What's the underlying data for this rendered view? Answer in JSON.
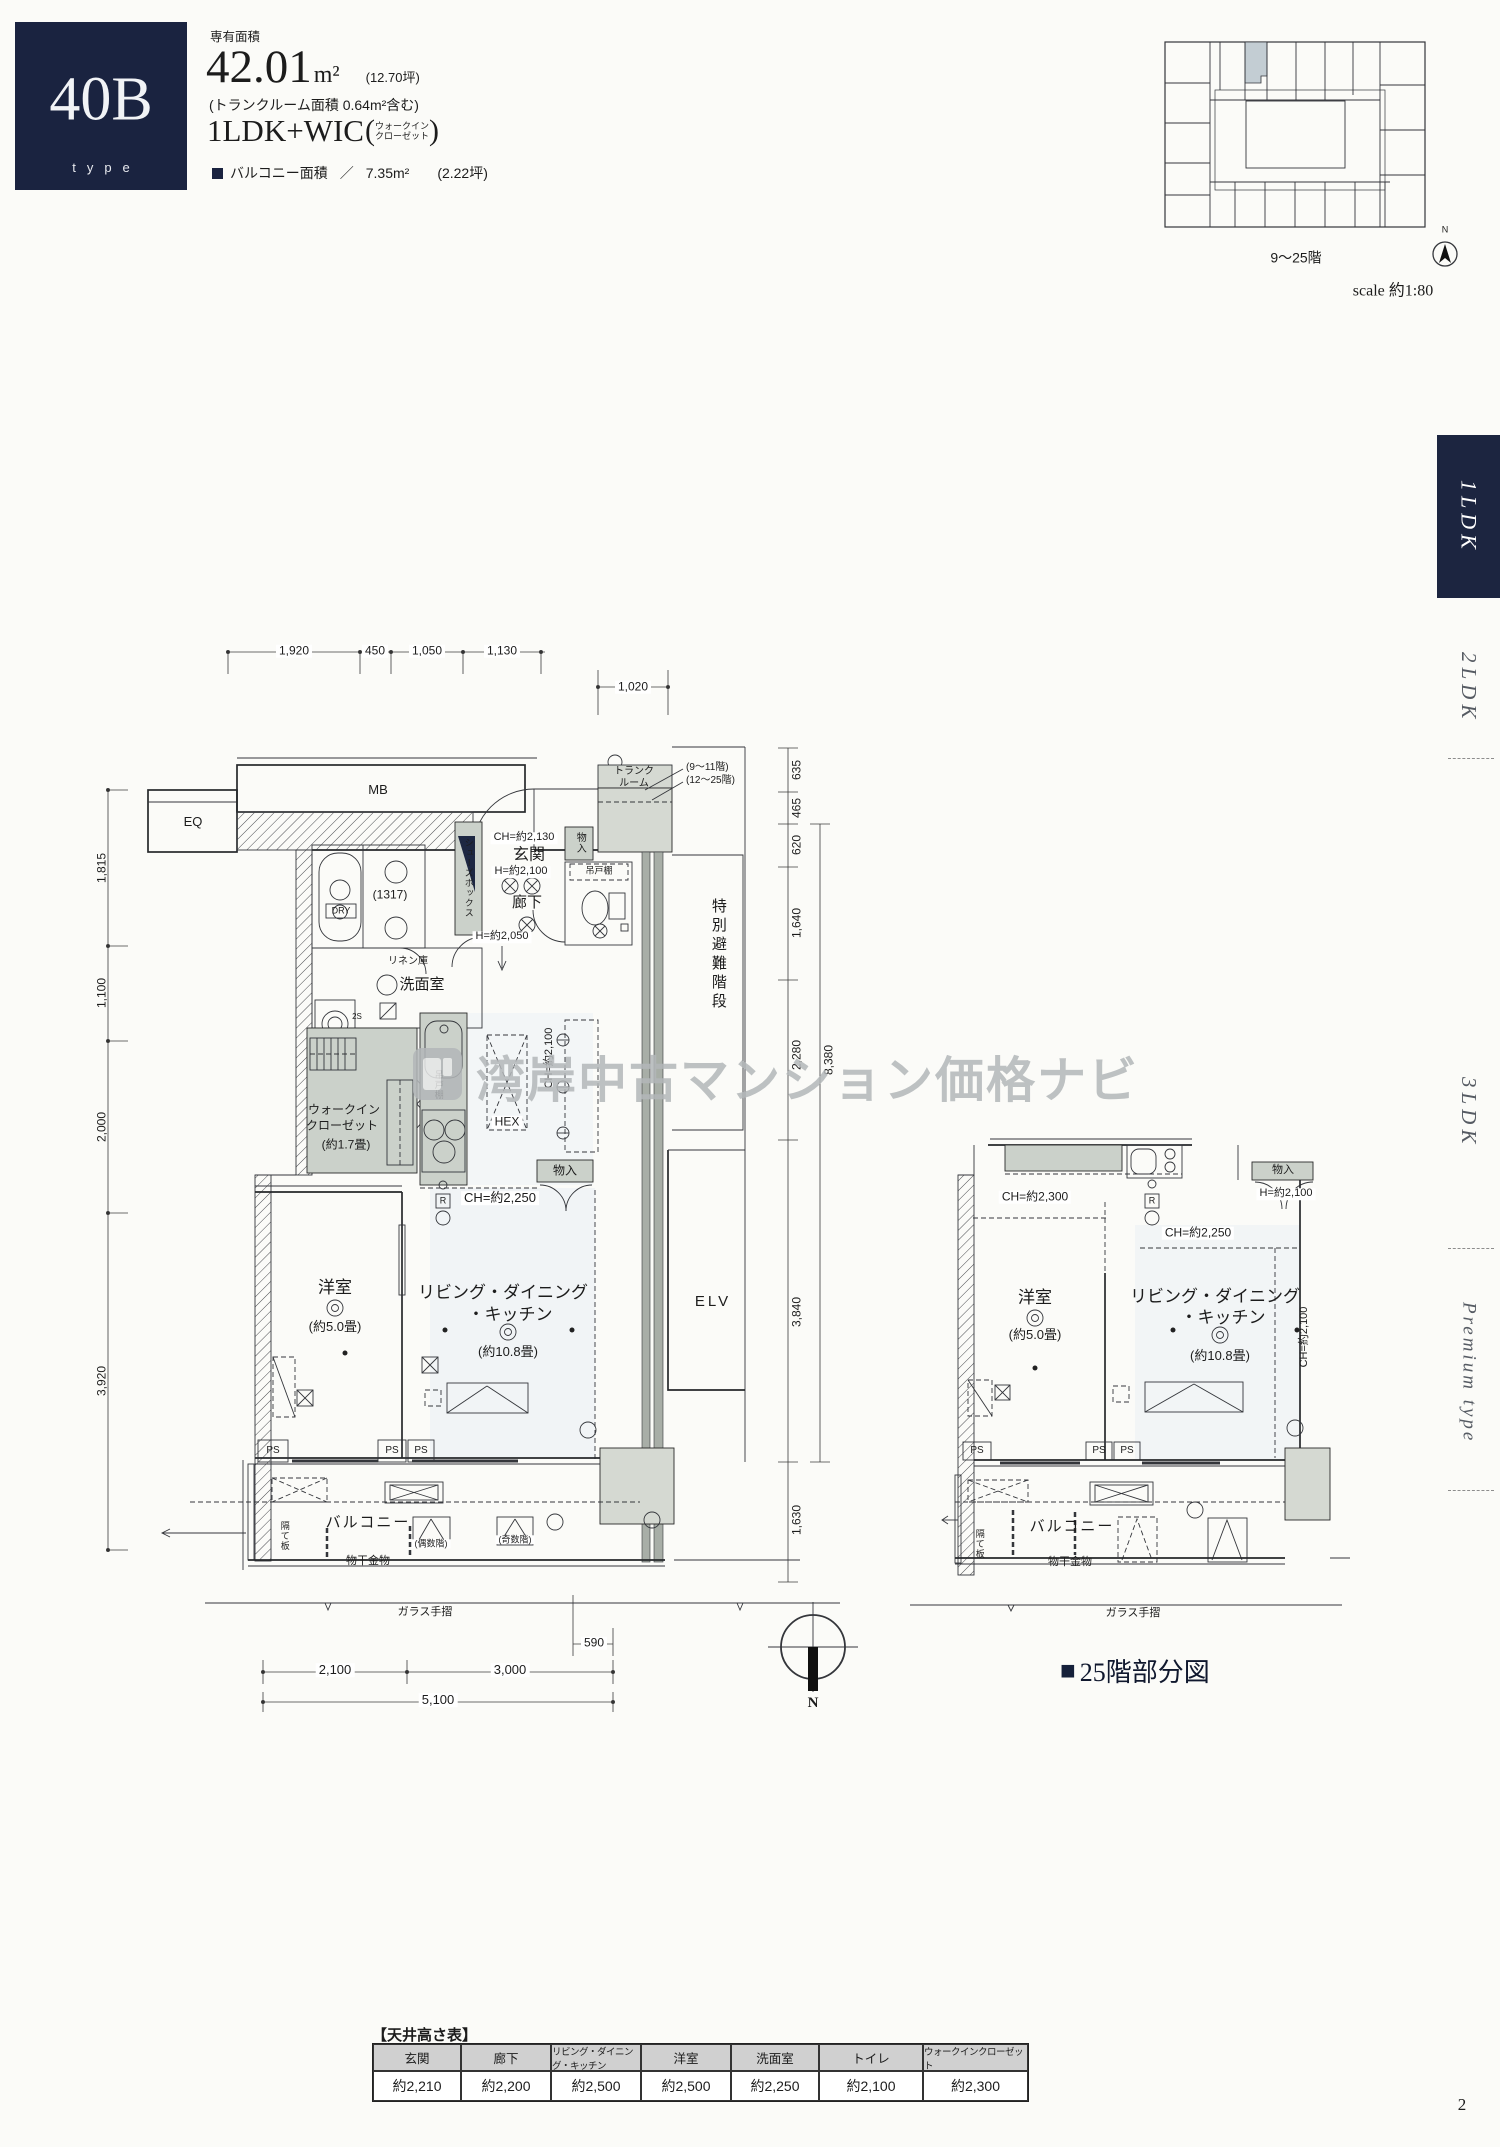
{
  "page_number": "2",
  "header": {
    "unit_code": "40B",
    "unit_code_sub": "type",
    "area_caption": "専有面積",
    "area_value": "42.01",
    "area_unit": "m²",
    "area_tsubo": "(12.70坪)",
    "area_note": "(トランクルーム面積 0.64m²含む)",
    "layout": "1LDK+WIC",
    "layout_sub1": "ウォークイン",
    "layout_sub2": "クローゼット",
    "balcony_label": "バルコニー面積",
    "balcony_sep": "／",
    "balcony_value": "7.35m²",
    "balcony_tsubo": "(2.22坪)"
  },
  "keyplan": {
    "floors_label": "9〜25階",
    "scale_label": "scale 約1:80",
    "north_label": "N"
  },
  "sidebar": {
    "tabs": [
      "1LDK",
      "2LDK",
      "3LDK",
      "Premium type"
    ],
    "active_tab": "1LDK",
    "active_color": "#1c2540"
  },
  "watermark": "湾岸中古マンション価格ナビ",
  "main_plan": {
    "eq": "EQ",
    "mb": "MB",
    "trunk_line1": "トランク",
    "trunk_line2": "ルーム",
    "trunk_note1": "(9〜11階)",
    "trunk_note2": "(12〜25階)",
    "ch_entrance": "CH=約2,130",
    "entrance": "玄関",
    "h_entrance": "H=約2,100",
    "storage1": "物入",
    "hanging1": "吊戸棚",
    "dry": "DRY",
    "bath_module": "(1317)",
    "shoes_box": "シューズボックス",
    "linen": "リネン庫",
    "corridor": "廊下",
    "h_corridor": "H=約2,050",
    "washroom": "洗面室",
    "washer_code": "2S",
    "evac_stairs": "特別避難階段",
    "wic_line1": "ウォークイン",
    "wic_line2": "クローゼット",
    "wic_size": "(約1.7畳)",
    "hanging2": "吊戸棚",
    "hex": "HEX",
    "ch_kitchen": "CH=約2,100",
    "storage2": "物入",
    "r_symbol": "R",
    "ch_ldk": "CH=約2,250",
    "bedroom": "洋室",
    "bedroom_size": "(約5.0畳)",
    "ldk_line1": "リビング・ダイニング",
    "ldk_line2": "・キッチン",
    "ldk_size": "(約10.8畳)",
    "elevator": "ELV",
    "ps": "PS",
    "balcony": "バルコニー",
    "even_floors": "(偶数階)",
    "odd_floors": "(奇数階)",
    "partition": "隔て板",
    "drying": "物干金物",
    "glass_rail": "ガラス手摺",
    "north_label": "N",
    "dims_top": [
      "1,920",
      "450",
      "1,050",
      "1,130"
    ],
    "dim_1020": "1,020",
    "dims_left": [
      "1,815",
      "1,100",
      "2,000",
      "3,920"
    ],
    "dims_right": [
      "635",
      "465",
      "620",
      "1,640",
      "2,280"
    ],
    "dim_total": "8,380",
    "dim_3840": "3,840",
    "dim_1630": "1,630",
    "dim_590": "590",
    "dims_bottom": [
      "2,100",
      "3,000",
      "5,100"
    ]
  },
  "sub_plan": {
    "ch_bedroom": "CH=約2,300",
    "storage": "物入",
    "h_storage": "H=約2,100",
    "ch_ldk": "CH=約2,250",
    "ch_kitchen": "CH=約2,100",
    "r_symbol": "R",
    "bedroom": "洋室",
    "bedroom_size": "(約5.0畳)",
    "ldk_line1": "リビング・ダイニング",
    "ldk_line2": "・キッチン",
    "ldk_size": "(約10.8畳)",
    "ps": "PS",
    "balcony": "バルコニー",
    "partition": "隔て板",
    "drying": "物干金物",
    "glass_rail": "ガラス手摺",
    "caption_marker": "■",
    "caption": "25階部分図"
  },
  "ceiling_table": {
    "title": "【天井高さ表】",
    "columns": [
      "玄関",
      "廊下",
      "リビング・ダイニング・キッチン",
      "洋室",
      "洗面室",
      "トイレ",
      "ウォークインクローゼット"
    ],
    "values": [
      "約2,210",
      "約2,200",
      "約2,500",
      "約2,500",
      "約2,250",
      "約2,100",
      "約2,300"
    ]
  }
}
